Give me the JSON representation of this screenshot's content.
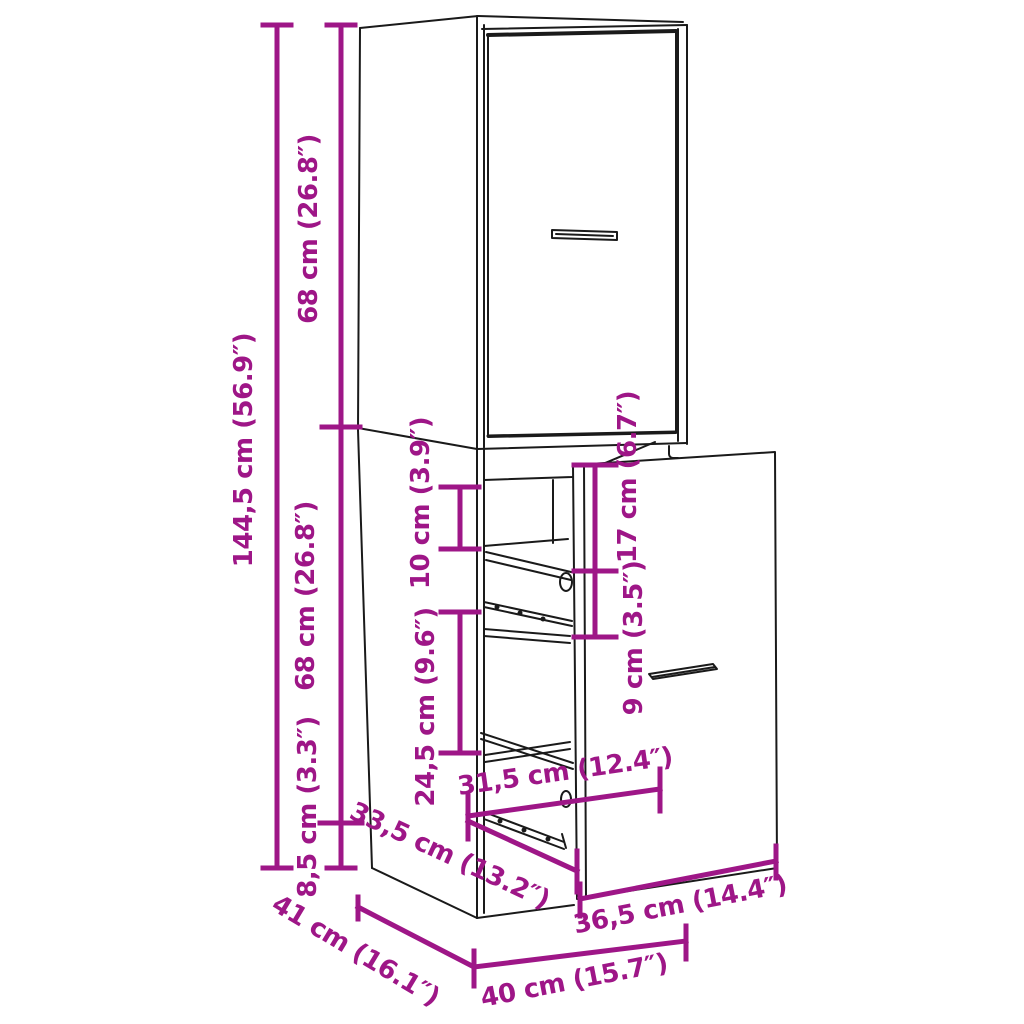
{
  "diagram": {
    "description": "apothecary cabinet technical dimension drawing",
    "colors": {
      "dimension_accent": "#9E1687",
      "outline": "#1A1A1A",
      "background": "#FFFFFF"
    },
    "dims": [
      {
        "id": "total-height",
        "label": "144,5 cm (56.9″)"
      },
      {
        "id": "upper-section-height",
        "label": "68 cm (26.8″)"
      },
      {
        "id": "lower-section-height",
        "label": "68 cm (26.8″)"
      },
      {
        "id": "plinth-height",
        "label": "8,5 cm (3.3″)"
      },
      {
        "id": "top-shelf-gap",
        "label": "10 cm (3.9″)"
      },
      {
        "id": "drawer-top-height",
        "label": "17 cm (6.7″)"
      },
      {
        "id": "middle-compartment",
        "label": "24,5 cm (9.6″)"
      },
      {
        "id": "drawer-inner-height",
        "label": "9 cm (3.5″)"
      },
      {
        "id": "inner-width",
        "label": "31,5 cm (12.4″)"
      },
      {
        "id": "pullout-depth",
        "label": "33,5 cm (13.2″)"
      },
      {
        "id": "drawer-front-width",
        "label": "36,5 cm (14.4″)"
      },
      {
        "id": "cabinet-width",
        "label": "40 cm (15.7″)"
      },
      {
        "id": "cabinet-depth",
        "label": "41 cm (16.1″)"
      }
    ]
  }
}
